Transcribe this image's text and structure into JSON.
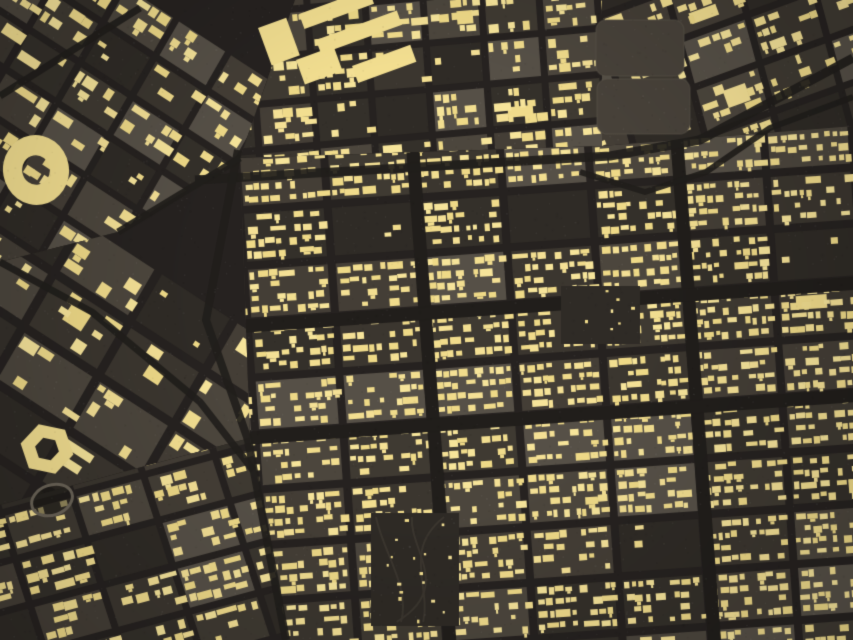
{
  "map": {
    "kind": "satellite-building-footprint-overlay",
    "width": 853,
    "height": 640,
    "seed": 1337
  },
  "palette": {
    "base": "#38332d",
    "street": "#262220",
    "road": "#211e1b",
    "ground": [
      "#3b362f",
      "#443e36",
      "#34302a",
      "#4c463d",
      "#565047",
      "#3f3a32"
    ],
    "ground_empty": "#2f2b26",
    "building_tones": [
      "#f6e49a",
      "#f2de90",
      "#eed987",
      "#f4e095",
      "#f0db8b"
    ],
    "building": "#f2de90",
    "stadium_track": "#6b6458",
    "park": "#2e2a25",
    "park_path": "#3b362f",
    "field": "#48423a",
    "field_edge": "#5a5349",
    "grain_light": "#ffffff",
    "grain_dark": "#000000",
    "vignette": "rgba(0,0,0,0.20)"
  },
  "texture": {
    "patches": 340,
    "grain": 2600
  },
  "districts": [
    {
      "name": "upper-left-old-town",
      "poly": [
        [
          0,
          0
        ],
        [
          295,
          0
        ],
        [
          240,
          158
        ],
        [
          118,
          232
        ],
        [
          0,
          262
        ]
      ],
      "ox": 0,
      "oy": -40,
      "rowAngle": 33,
      "colAngle": 120,
      "bw": 62,
      "bh": 46,
      "sw": 7,
      "sh": 7,
      "hw": 11,
      "hh": 9,
      "hv": 5,
      "pitch": 16,
      "density": 0.55,
      "empty": 0.1,
      "slab": 0.1,
      "midlane": 0
    },
    {
      "name": "west-campus",
      "poly": [
        [
          0,
          262
        ],
        [
          118,
          232
        ],
        [
          240,
          158
        ],
        [
          250,
          438
        ],
        [
          0,
          505
        ]
      ],
      "ox": -20,
      "oy": 230,
      "rowAngle": 33,
      "colAngle": 120,
      "bw": 90,
      "bh": 62,
      "sw": 9,
      "sh": 9,
      "hw": 13,
      "hh": 10,
      "hv": 7,
      "pitch": 18,
      "density": 0.3,
      "empty": 0.26,
      "slab": 0.14,
      "midlane": 0
    },
    {
      "name": "southwest-grid",
      "poly": [
        [
          0,
          505
        ],
        [
          250,
          438
        ],
        [
          288,
          640
        ],
        [
          0,
          640
        ]
      ],
      "ox": -10,
      "oy": 470,
      "rowAngle": -15,
      "colAngle": 72,
      "bw": 74,
      "bh": 48,
      "sw": 7,
      "sh": 7,
      "hw": 9,
      "hh": 7,
      "hv": 4,
      "pitch": 13,
      "density": 0.62,
      "empty": 0.08,
      "slab": 0.06,
      "midlane": 0
    },
    {
      "name": "top-middle-grid",
      "poly": [
        [
          295,
          0
        ],
        [
          602,
          0
        ],
        [
          602,
          146
        ],
        [
          240,
          158
        ]
      ],
      "ox": 250,
      "oy": -30,
      "rowAngle": -5,
      "colAngle": 86,
      "bw": 58,
      "bh": 46,
      "sw": 7,
      "sh": 7,
      "hw": 8,
      "hh": 7,
      "hv": 4,
      "pitch": 13,
      "density": 0.62,
      "empty": 0.14,
      "slab": 0.1,
      "midlane": 0
    },
    {
      "name": "top-right-fields-zone",
      "poly": [
        [
          602,
          0
        ],
        [
          853,
          0
        ],
        [
          853,
          126
        ],
        [
          602,
          146
        ]
      ],
      "ox": 590,
      "oy": -30,
      "rowAngle": -20,
      "colAngle": 75,
      "bw": 72,
      "bh": 50,
      "sw": 7,
      "sh": 7,
      "hw": 8,
      "hh": 7,
      "hv": 4,
      "pitch": 13,
      "density": 0.45,
      "empty": 0.28,
      "slab": 0.06,
      "midlane": 0
    },
    {
      "name": "central-rowhouse-grid",
      "poly": [
        [
          240,
          158
        ],
        [
          602,
          146
        ],
        [
          853,
          126
        ],
        [
          853,
          640
        ],
        [
          288,
          640
        ],
        [
          250,
          438
        ]
      ],
      "ox": 240,
      "oy": 158,
      "rowAngle": -4,
      "colAngle": 86,
      "bw": 88,
      "bh": 56,
      "sw": 8,
      "sh": 8,
      "hw": 7,
      "hh": 6,
      "hv": 3,
      "pitch": 12,
      "density": 0.88,
      "empty": 0.05,
      "slab": 0.05,
      "midlane": 6,
      "majorCols": [
        2,
        5
      ],
      "majorRows": [
        3,
        5
      ],
      "majorExtra": 5
    }
  ],
  "roads": [
    {
      "name": "grid-north-boundary-road",
      "pts": [
        [
          195,
          180
        ],
        [
          610,
          156
        ],
        [
          700,
          140
        ],
        [
          853,
          58
        ]
      ],
      "w": 9
    },
    {
      "name": "west-boundary-road",
      "pts": [
        [
          238,
          150
        ],
        [
          206,
          320
        ],
        [
          248,
          440
        ],
        [
          286,
          640
        ]
      ],
      "w": 8
    },
    {
      "name": "southwest-diagonal-road",
      "pts": [
        [
          0,
          262
        ],
        [
          92,
          312
        ],
        [
          200,
          402
        ],
        [
          253,
          470
        ]
      ],
      "w": 7
    },
    {
      "name": "northeast-curved-road",
      "pts": [
        [
          580,
          172
        ],
        [
          645,
          192
        ],
        [
          706,
          172
        ],
        [
          770,
          128
        ],
        [
          853,
          97
        ]
      ],
      "w": 6
    },
    {
      "name": "topleft-corner-road",
      "pts": [
        [
          0,
          96
        ],
        [
          60,
          58
        ],
        [
          140,
          8
        ]
      ],
      "w": 7
    },
    {
      "name": "oldtown-diagonal-road",
      "pts": [
        [
          118,
          232
        ],
        [
          240,
          158
        ]
      ],
      "w": 7
    }
  ],
  "features": [
    {
      "type": "ring",
      "name": "circular-ring-building",
      "cx": 36,
      "cy": 170,
      "rx": 33,
      "ry": 35,
      "inner": 0.42,
      "rot": -10,
      "sides": 0
    },
    {
      "type": "ring",
      "name": "polygon-ring-building",
      "cx": 47,
      "cy": 449,
      "rx": 27,
      "ry": 26,
      "inner": 0.45,
      "rot": 12,
      "sides": 6
    },
    {
      "type": "stadium",
      "name": "stadium-track",
      "cx": 52,
      "cy": 500,
      "rx": 21,
      "ry": 15,
      "rot": -20
    },
    {
      "type": "field",
      "name": "open-field-1",
      "x": 596,
      "y": 20,
      "w": 88,
      "h": 56,
      "r": 10
    },
    {
      "type": "field",
      "name": "open-field-2",
      "x": 597,
      "y": 79,
      "w": 93,
      "h": 55,
      "r": 10
    },
    {
      "type": "park",
      "name": "park-block",
      "x": 371,
      "y": 513,
      "w": 88,
      "h": 113,
      "dots": 16
    },
    {
      "type": "openblock",
      "name": "vacant-block",
      "x": 561,
      "y": 286,
      "w": 79,
      "h": 58,
      "dots": 7
    },
    {
      "type": "slab",
      "name": "large-building-slab",
      "x": 299,
      "y": 14,
      "w": 74,
      "h": 16,
      "rot": -20
    },
    {
      "type": "slab",
      "name": "large-building-slab",
      "x": 316,
      "y": 40,
      "w": 86,
      "h": 15,
      "rot": -20
    },
    {
      "type": "slab",
      "name": "large-building-slab",
      "x": 352,
      "y": 66,
      "w": 62,
      "h": 18,
      "rot": -20
    },
    {
      "type": "slab",
      "name": "large-building-slab",
      "x": 296,
      "y": 60,
      "w": 40,
      "h": 26,
      "rot": -20
    },
    {
      "type": "slab",
      "name": "large-building-slab",
      "x": 258,
      "y": 28,
      "w": 30,
      "h": 40,
      "rot": -20
    }
  ]
}
